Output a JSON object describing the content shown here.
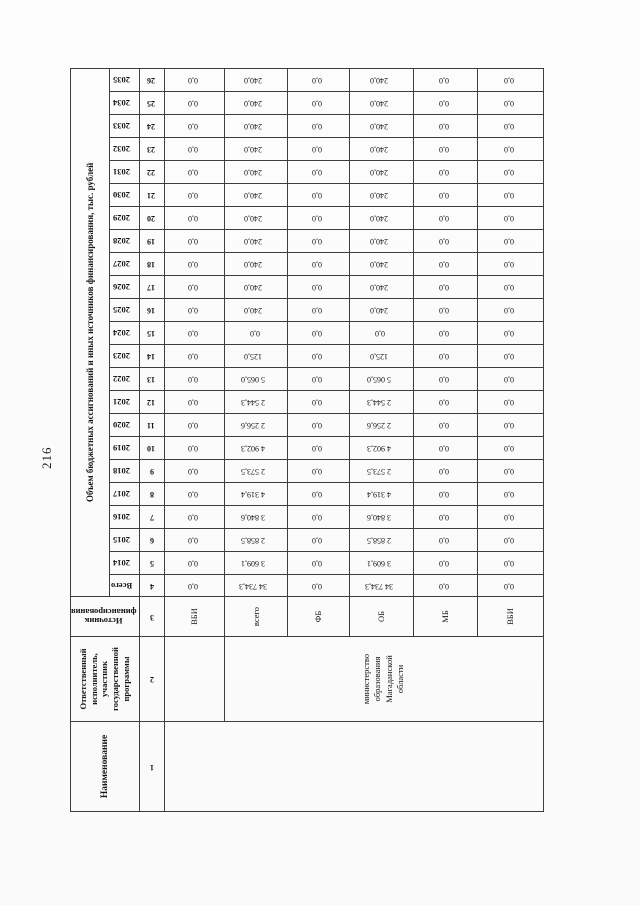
{
  "page": {
    "number": "216"
  },
  "table": {
    "headers": {
      "name": "Наименование",
      "executor_lines": [
        "Ответственный",
        "исполнитель,",
        "участник",
        "государственной",
        "программы"
      ],
      "source_lines": [
        "Источник",
        "финансирования"
      ],
      "volume": "Объем бюджетных ассигнований и иных источников финансирования, тыс. рублей",
      "total": "Всего"
    },
    "years": [
      "2014",
      "2015",
      "2016",
      "2017",
      "2018",
      "2019",
      "2020",
      "2021",
      "2022",
      "2023",
      "2024",
      "2025",
      "2026",
      "2027",
      "2028",
      "2029",
      "2030",
      "2031",
      "2032",
      "2033",
      "2034",
      "2035"
    ],
    "col_numbers": [
      "1",
      "2",
      "3",
      "4",
      "5",
      "6",
      "7",
      "8",
      "9",
      "10",
      "11",
      "12",
      "13",
      "14",
      "15",
      "16",
      "17",
      "18",
      "19",
      "20",
      "21",
      "22",
      "23",
      "24",
      "25",
      "26"
    ],
    "executor_value_lines": [
      "министерство",
      "образования",
      "Магаданской",
      "области"
    ],
    "rows": [
      {
        "source": "ВБИ",
        "total": "0,0",
        "values": [
          "0,0",
          "0,0",
          "0,0",
          "0,0",
          "0,0",
          "0,0",
          "0,0",
          "0,0",
          "0,0",
          "0,0",
          "0,0",
          "0,0",
          "0,0",
          "0,0",
          "0,0",
          "0,0",
          "0,0",
          "0,0",
          "0,0",
          "0,0",
          "0,0",
          "0,0"
        ]
      },
      {
        "source": "всего",
        "total": "34 734,3",
        "values": [
          "3 609,1",
          "2 858,5",
          "3 840,6",
          "4 319,4",
          "2 573,5",
          "4 902,3",
          "2 256,6",
          "2 544,3",
          "5 065,0",
          "125,0",
          "0,0",
          "240,0",
          "240,0",
          "240,0",
          "240,0",
          "240,0",
          "240,0",
          "240,0",
          "240,0",
          "240,0",
          "240,0",
          "240,0"
        ]
      },
      {
        "source": "ФБ",
        "total": "0,0",
        "values": [
          "0,0",
          "0,0",
          "0,0",
          "0,0",
          "0,0",
          "0,0",
          "0,0",
          "0,0",
          "0,0",
          "0,0",
          "0,0",
          "0,0",
          "0,0",
          "0,0",
          "0,0",
          "0,0",
          "0,0",
          "0,0",
          "0,0",
          "0,0",
          "0,0",
          "0,0"
        ]
      },
      {
        "source": "ОБ",
        "total": "34 734,3",
        "values": [
          "3 609,1",
          "2 858,5",
          "3 840,6",
          "4 319,4",
          "2 573,5",
          "4 902,3",
          "2 256,6",
          "2 544,3",
          "5 065,0",
          "125,0",
          "0,0",
          "240,0",
          "240,0",
          "240,0",
          "240,0",
          "240,0",
          "240,0",
          "240,0",
          "240,0",
          "240,0",
          "240,0",
          "240,0"
        ]
      },
      {
        "source": "МБ",
        "total": "0,0",
        "values": [
          "0,0",
          "0,0",
          "0,0",
          "0,0",
          "0,0",
          "0,0",
          "0,0",
          "0,0",
          "0,0",
          "0,0",
          "0,0",
          "0,0",
          "0,0",
          "0,0",
          "0,0",
          "0,0",
          "0,0",
          "0,0",
          "0,0",
          "0,0",
          "0,0",
          "0,0"
        ]
      },
      {
        "source": "ВБИ",
        "total": "0,0",
        "values": [
          "0,0",
          "0,0",
          "0,0",
          "0,0",
          "0,0",
          "0,0",
          "0,0",
          "0,0",
          "0,0",
          "0,0",
          "0,0",
          "0,0",
          "0,0",
          "0,0",
          "0,0",
          "0,0",
          "0,0",
          "0,0",
          "0,0",
          "0,0",
          "0,0",
          "0,0"
        ]
      }
    ]
  },
  "layout": {
    "col_widths": [
      90,
      85,
      40,
      22
    ],
    "year_col_width": 23,
    "row_heights": [
      35,
      25,
      25,
      60,
      63,
      62,
      64,
      64,
      66
    ]
  }
}
